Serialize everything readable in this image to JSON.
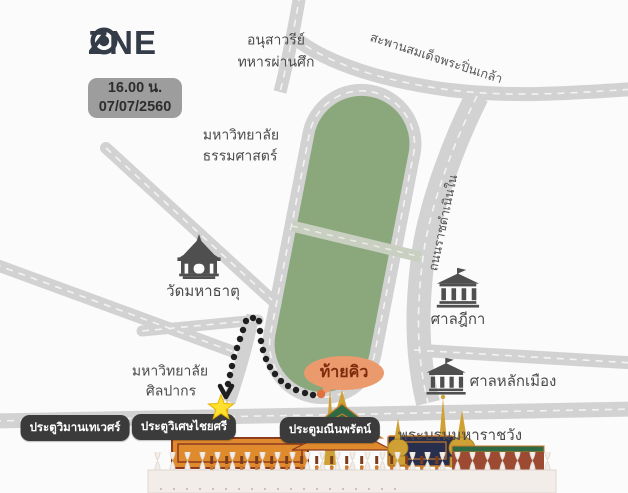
{
  "brand": {
    "prefix": "Z",
    "suffix": "NE",
    "o_icon": "circle-dot-icon"
  },
  "info_badge": {
    "time": "16.00 น.",
    "date": "07/07/2560"
  },
  "colors": {
    "bg": "#fbfbfb",
    "road": "#d2d2d2",
    "road_dash": "#f3f3f1",
    "field_green": "#8aa87c",
    "field_path": "#c9cfc1",
    "text": "#4a4a4a",
    "badge_bg": "#3b3b3b",
    "badge_text": "#ffffff",
    "queue_bubble_bg": "#ea9a6d",
    "queue_bubble_text": "#7c2c0c",
    "star": "#ffe02e",
    "queue_dot": "#1f1f1f",
    "queue_end_dot": "#e2703d",
    "icon_dark": "#4f4f4f",
    "brand": "#333c47",
    "timebox_bg": "#9d9d9d",
    "timebox_text": "#2d2d2d"
  },
  "map": {
    "places": {
      "veterans_monument": {
        "line1": "อนุสาวรีย์",
        "line2": "ทหารผ่านศึก"
      },
      "pinklao_bridge": {
        "label": "สะพานสมเด็จพระปิ่นเกล้า"
      },
      "thammasat_university": {
        "line1": "มหาวิทยาลัย",
        "line2": "ธรรมศาสตร์"
      },
      "wat_mahathat": {
        "label": "วัดมหาธาตุ",
        "icon": "thai-temple-icon"
      },
      "ratchadamnoen_road": {
        "label": "ถนนราชดำเนินใน"
      },
      "supreme_court": {
        "label": "ศาลฎีกา",
        "icon": "courthouse-icon"
      },
      "city_pillar_shrine": {
        "label": "ศาลหลักเมือง",
        "icon": "courthouse-icon"
      },
      "silpakorn_university": {
        "line1": "มหาวิทยาลัย",
        "line2": "ศิลปากร"
      },
      "grand_palace": {
        "label": "พระบรมมหาราชวัง",
        "icon": "grand-palace-illustration"
      }
    },
    "queue": {
      "end_label": "ท้ายคิว",
      "entry_marker": "star-icon",
      "route_marker": "dotted-path"
    },
    "gates": [
      {
        "label": "ประตูวิมานเทเวศร์"
      },
      {
        "label": "ประตูวิเศษไชยศรี"
      },
      {
        "label": "ประตูมณีนพรัตน์"
      }
    ]
  }
}
